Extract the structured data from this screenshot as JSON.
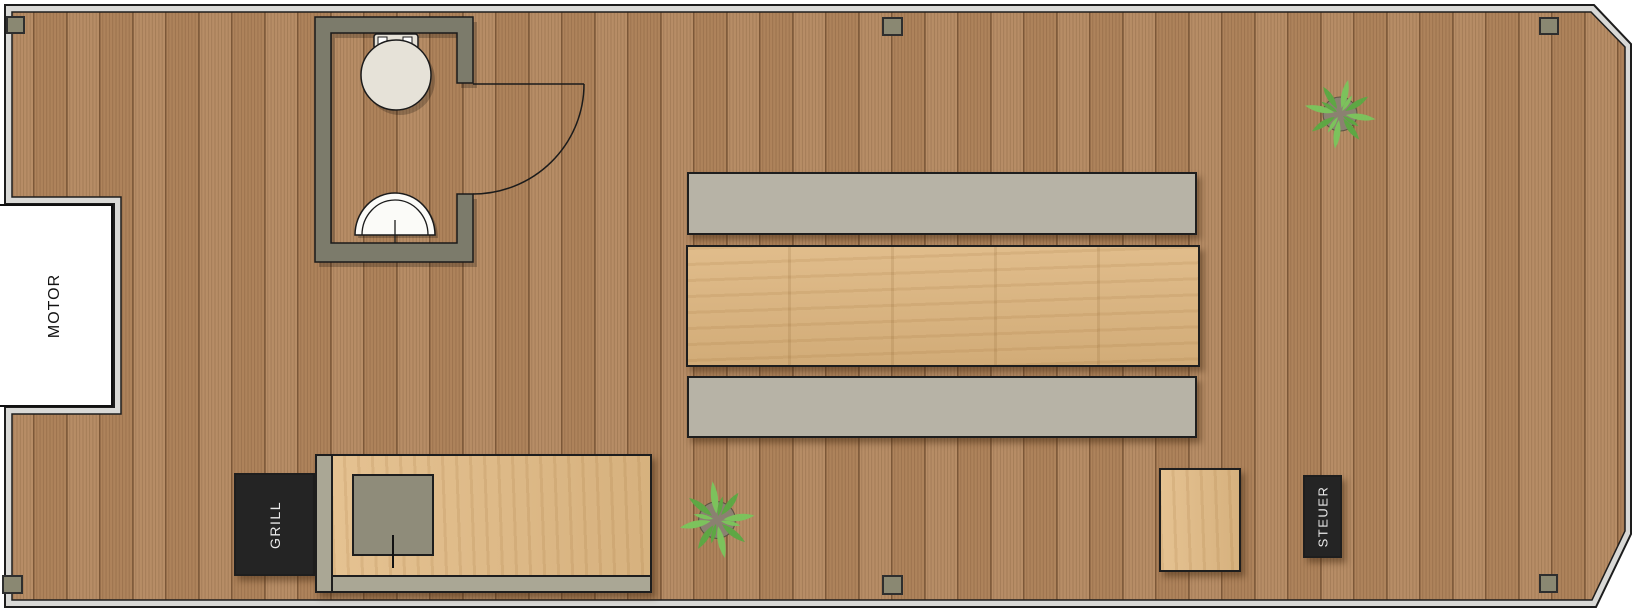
{
  "labels": {
    "motor": "MOTOR",
    "grill": "GRILL",
    "steuer": "STEUER"
  },
  "objects": {
    "bathroom": [
      "toilet",
      "sink",
      "door-swing"
    ],
    "seating": [
      "bench",
      "dining-table",
      "bench"
    ],
    "kitchen": [
      "counter",
      "kitchen-sink",
      "grill"
    ],
    "deck": [
      "plant",
      "plant",
      "side-table",
      "steering-console",
      "motor-well"
    ],
    "cleat_count": 6
  },
  "colors": {
    "deck_wood": "#b78d66",
    "deck_wood_alt": "#ae835b",
    "hull_band": "#d9d9d6",
    "wall": "#7c7b6b",
    "bench": "#b7b3a6",
    "table_wood": "#ddb57e",
    "counter_wood": "#e2bb85",
    "counter_trim": "#aaa795",
    "sink_metal": "#8f8c7a",
    "appliance_black": "#242424",
    "appliance_text": "#e9e9e9",
    "motor_text": "#111111",
    "porcelain": "#e6e2d8",
    "plant_leaf": "#7cc25c",
    "plant_leaf_dark": "#5ea744",
    "plant_pot": "#8b8171",
    "cleat": "#8a8872"
  }
}
